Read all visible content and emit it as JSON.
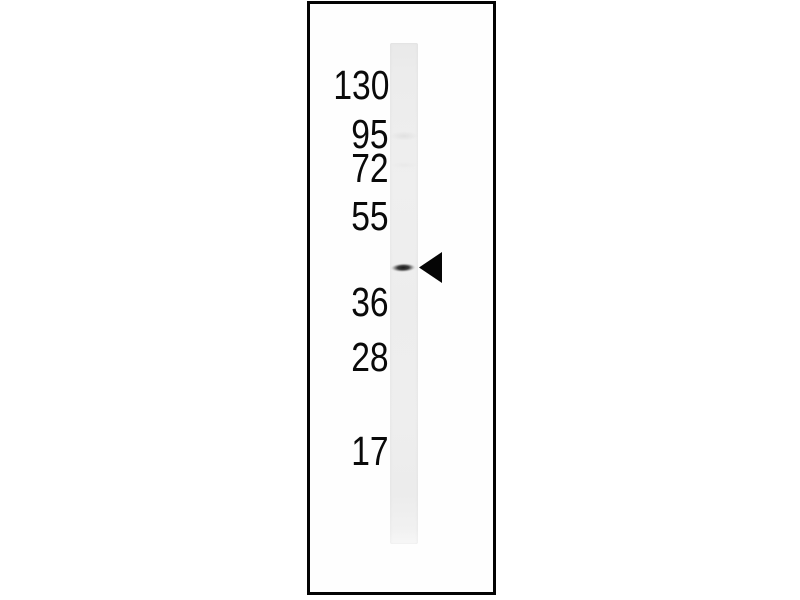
{
  "figure": {
    "kind": "western-blot-figure",
    "markers": {
      "labels": [
        "130",
        "95",
        "72",
        "55",
        "36",
        "28",
        "17"
      ]
    },
    "icons": {
      "band_pointer": "left-filled-triangle-arrowhead"
    },
    "colors": {
      "background": "#ffffff",
      "panel_border": "#030303",
      "lane": "#ededed",
      "band": "#2e2e2e",
      "label_text": "#0a0a0a",
      "arrowhead": "#050505"
    }
  }
}
